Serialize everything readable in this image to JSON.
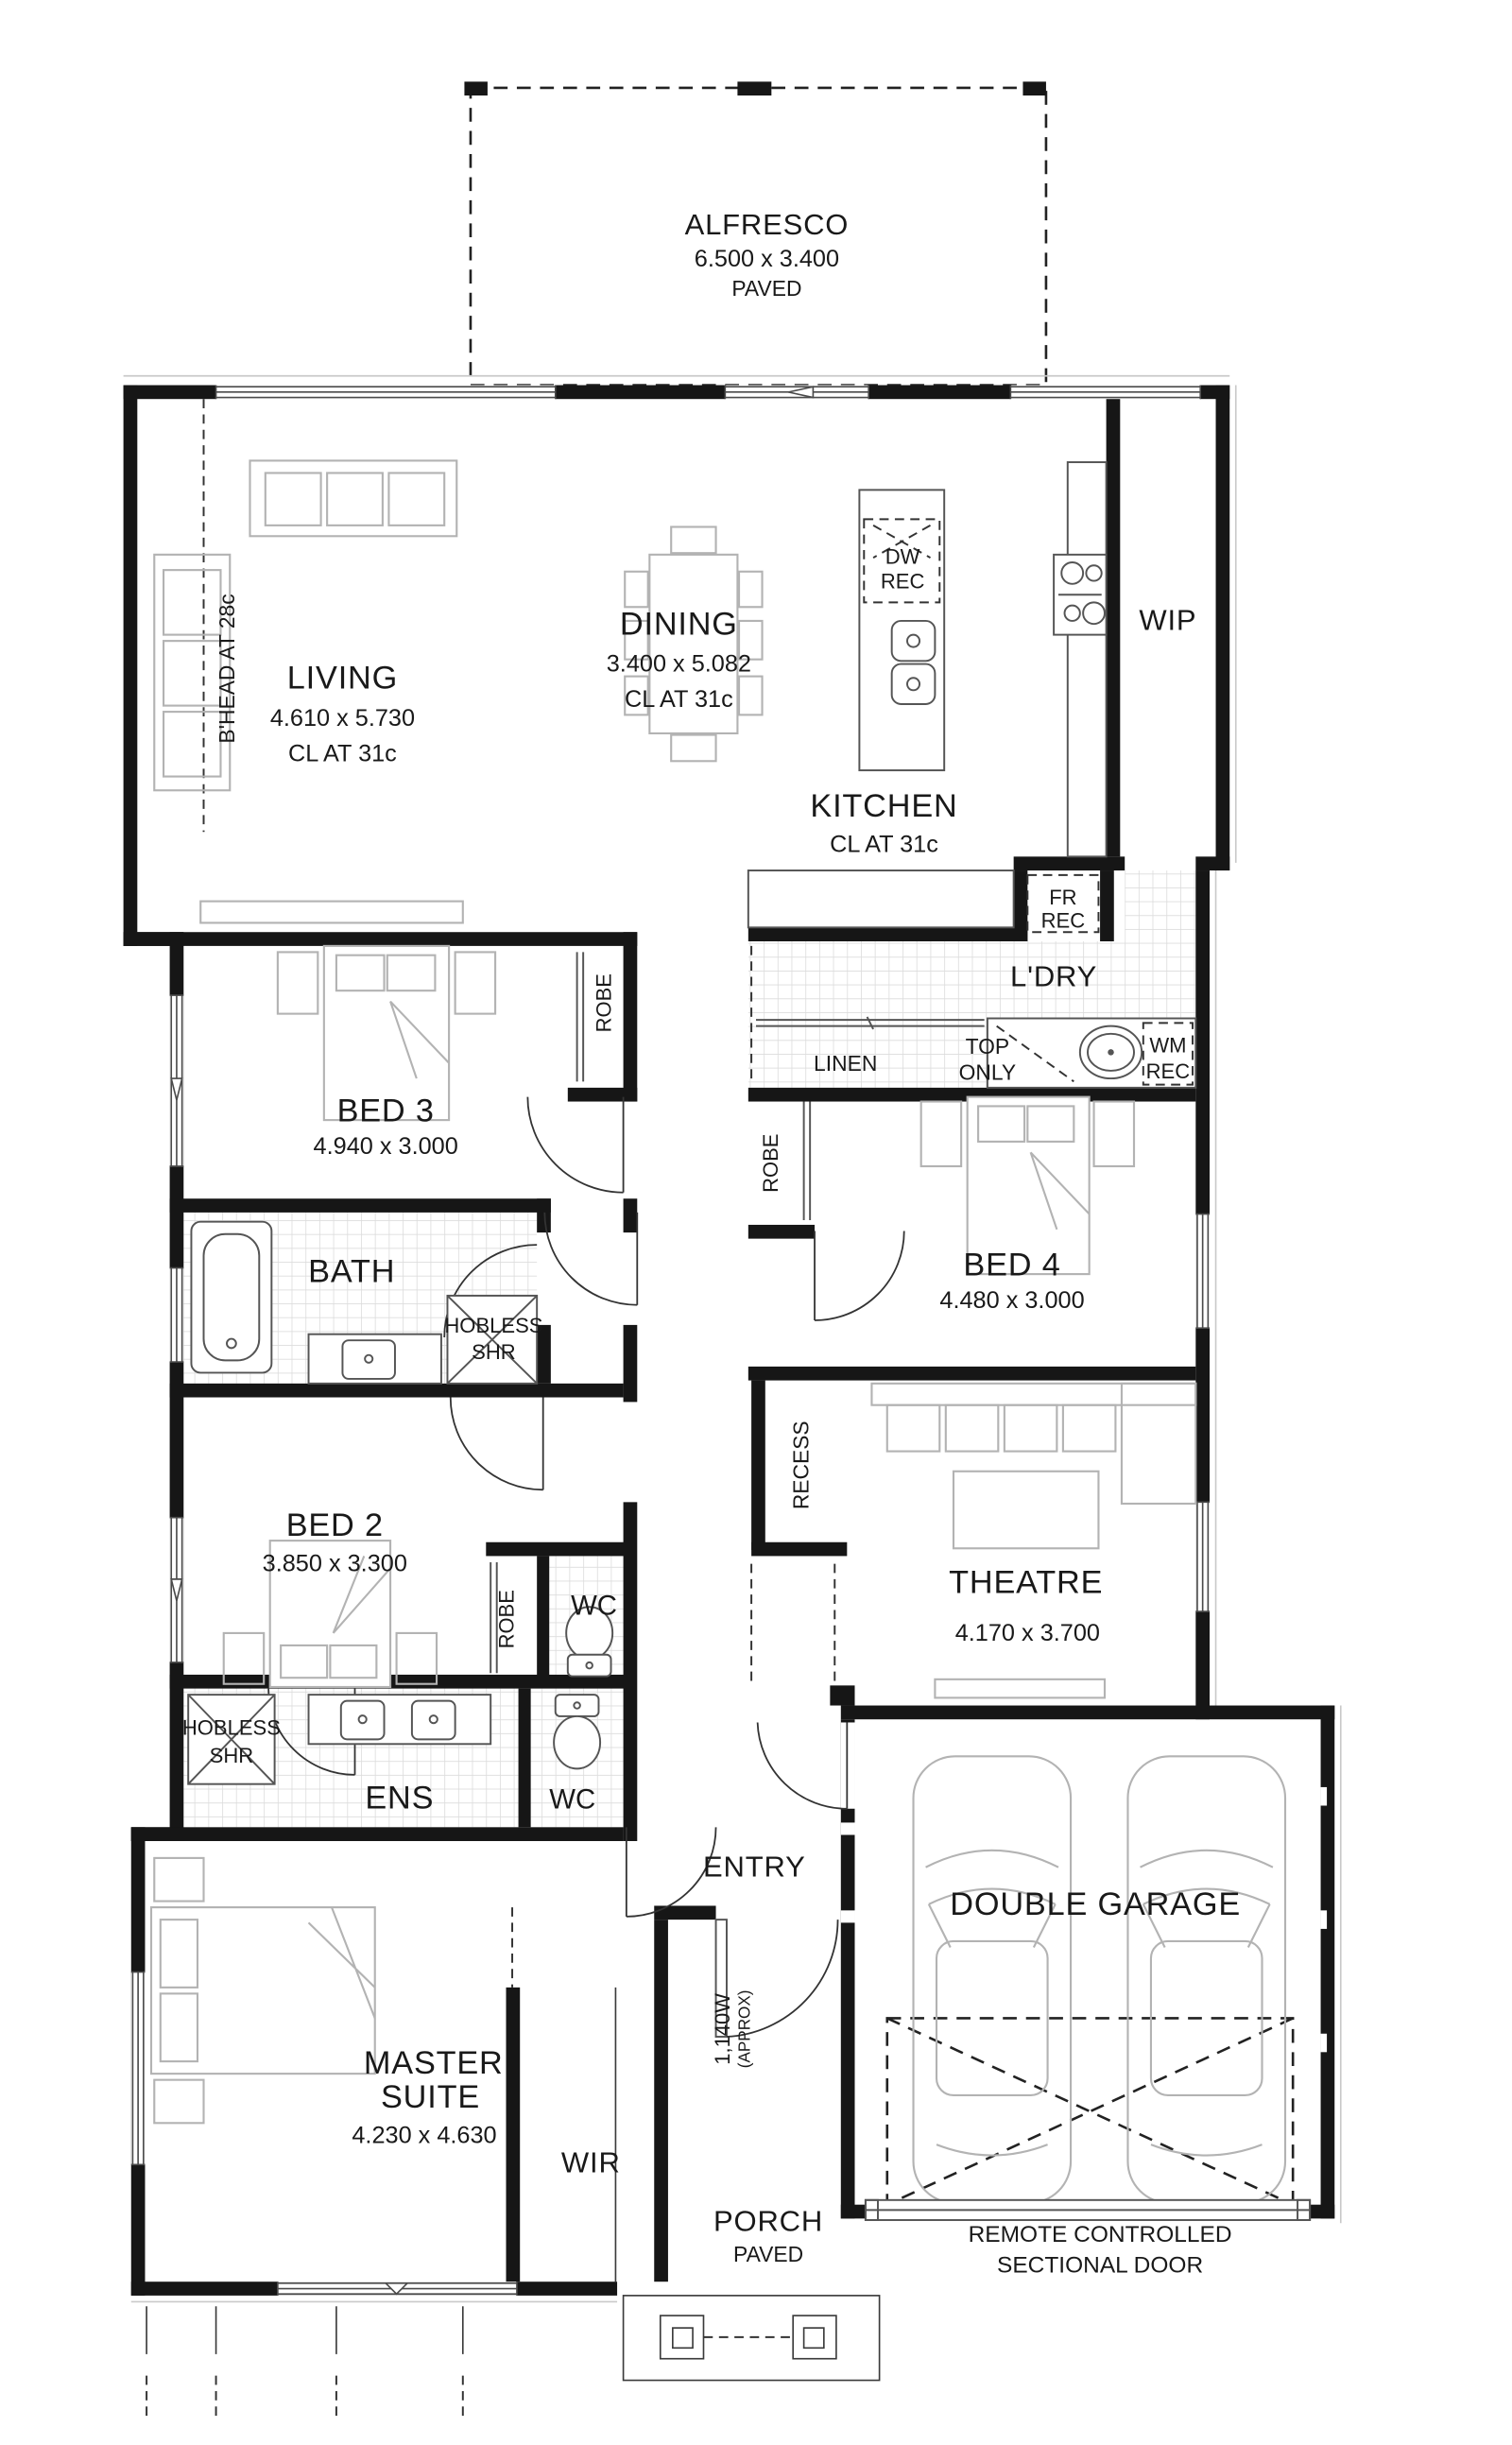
{
  "plan": {
    "alfresco": {
      "name": "ALFRESCO",
      "dims": "6.500 x 3.400",
      "surface": "PAVED"
    },
    "living": {
      "name": "LIVING",
      "dims": "4.610 x 5.730",
      "ceiling": "CL AT 31c",
      "bulkhead": "B'HEAD AT 28c"
    },
    "dining": {
      "name": "DINING",
      "dims": "3.400 x 5.082",
      "ceiling": "CL AT 31c"
    },
    "kitchen": {
      "name": "KITCHEN",
      "ceiling": "CL AT 31c",
      "dw_recess": {
        "l1": "DW",
        "l2": "REC"
      },
      "fridge_recess": {
        "l1": "FR",
        "l2": "REC"
      }
    },
    "wip": {
      "name": "WIP"
    },
    "laundry": {
      "name": "L'DRY",
      "linen": "LINEN",
      "bench": {
        "l1": "TOP",
        "l2": "ONLY"
      },
      "wm_recess": {
        "l1": "WM",
        "l2": "REC"
      }
    },
    "bed3": {
      "name": "BED 3",
      "dims": "4.940 x 3.000",
      "robe": "ROBE"
    },
    "bed4": {
      "name": "BED 4",
      "dims": "4.480 x 3.000",
      "robe": "ROBE"
    },
    "bed2": {
      "name": "BED 2",
      "dims": "3.850 x 3.300",
      "robe": "ROBE"
    },
    "bath": {
      "name": "BATH",
      "shower": {
        "l1": "HOBLESS",
        "l2": "SHR"
      }
    },
    "ens": {
      "name": "ENS",
      "shower": {
        "l1": "HOBLESS",
        "l2": "SHR"
      }
    },
    "wc_upper": "WC",
    "wc_lower": "WC",
    "theatre": {
      "name": "THEATRE",
      "dims": "4.170 x 3.700"
    },
    "recess": "RECESS",
    "entry": {
      "name": "ENTRY",
      "door": {
        "l1": "1,140W",
        "l2": "(APPROX)"
      }
    },
    "master": {
      "name_l1": "MASTER",
      "name_l2": "SUITE",
      "dims": "4.230 x 4.630"
    },
    "wir": "WIR",
    "porch": {
      "name": "PORCH",
      "surface": "PAVED"
    },
    "garage": {
      "name": "DOUBLE GARAGE",
      "door_l1": "REMOTE CONTROLLED",
      "door_l2": "SECTIONAL DOOR"
    }
  },
  "colors": {
    "wall": "#161616",
    "furniture": "#b3b3b3",
    "tile": "#d9d9d9",
    "text": "#191919"
  }
}
